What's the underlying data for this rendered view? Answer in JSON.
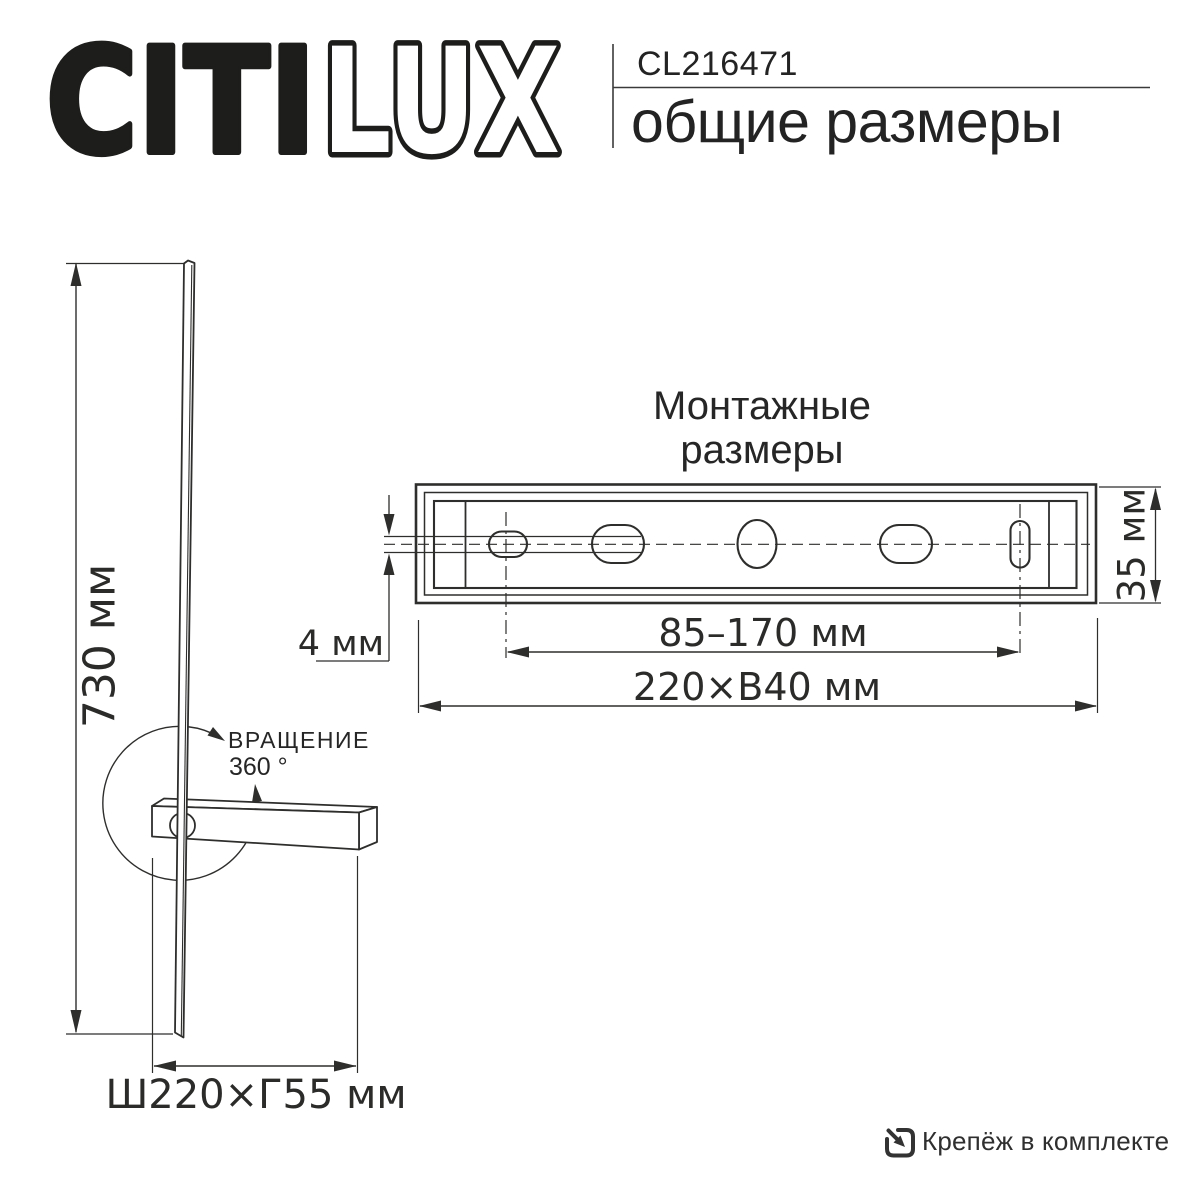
{
  "header": {
    "brand": {
      "citi": "CITI",
      "lux": "LUX"
    },
    "product_code": "CL216471",
    "subtitle": "общие размеры"
  },
  "side_view": {
    "height_dim": "730 мм",
    "rotation_label_line1": "ВРАЩЕНИЕ",
    "rotation_label_line2": "360 °",
    "base_dim": "Ш220×Г55 мм"
  },
  "mounting_view": {
    "title_line1": "Монтажные",
    "title_line2": "размеры",
    "slot_gap_dim": "4 мм",
    "height_dim": "35 мм",
    "hole_spacing_dim": "85–170 мм",
    "overall_dim": "220×В40 мм"
  },
  "footer": {
    "hardware_note": "Крепёж в комплекте"
  },
  "colors": {
    "ink": "#1d1d1b",
    "line": "#2e2e2d",
    "text": "#2b2b2a"
  }
}
